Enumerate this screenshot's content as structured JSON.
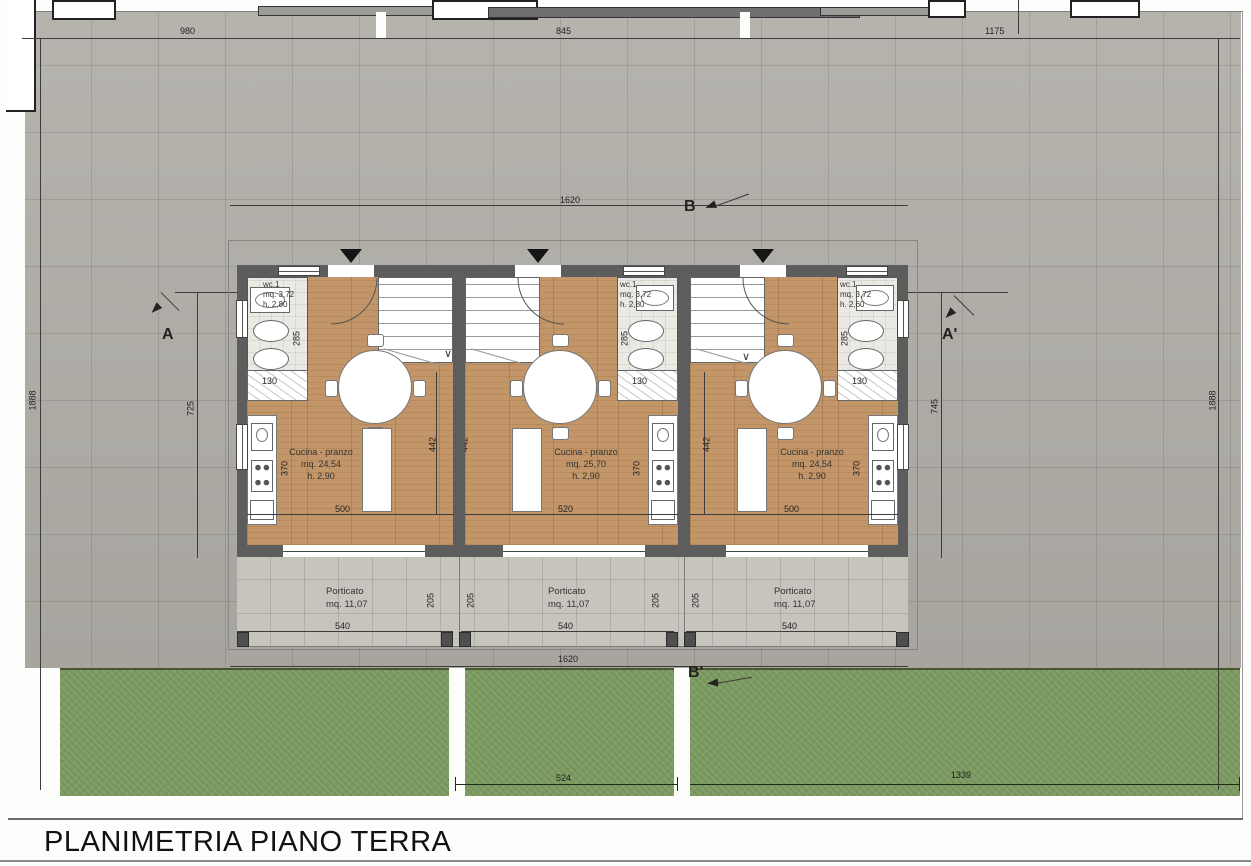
{
  "title": "PLANIMETRIA PIANO TERRA",
  "site": {
    "dim_top_left": "980",
    "dim_top_mid": "845",
    "dim_top_right": "1175",
    "dim_left": "1888",
    "dim_right": "1888",
    "dim_bottom_mid": "524",
    "dim_bottom_right": "1339",
    "dim_building_top": "1620",
    "dim_building_bottom": "1620",
    "dim_depth_left": "725",
    "dim_depth_right": "745"
  },
  "sections": {
    "a": "A",
    "a_prime": "A'",
    "b": "B",
    "b_prime": "B'"
  },
  "icons": {
    "stair_arrow": "∨"
  },
  "units": [
    {
      "kitchen_label": "Cucina - pranzo",
      "kitchen_area": "mq. 24,54",
      "kitchen_height": "h. 2,90",
      "wc_label": "wc.1",
      "wc_area": "mq. 3,72",
      "wc_height": "h. 2,80",
      "portico_label": "Porticato",
      "portico_area": "mq. 11,07",
      "dim_width": "500",
      "dim_depth": "370",
      "dim_wc_depth": "285",
      "dim_wc_width": "130",
      "dim_portico_width": "540",
      "dim_portico_depth": "205",
      "dim_mid": "442"
    },
    {
      "kitchen_label": "Cucina - pranzo",
      "kitchen_area": "mq. 25,70",
      "kitchen_height": "h. 2,90",
      "wc_label": "wc.1",
      "wc_area": "mq. 3,72",
      "wc_height": "h. 2,80",
      "portico_label": "Porticato",
      "portico_area": "mq. 11,07",
      "dim_width": "520",
      "dim_depth": "370",
      "dim_wc_depth": "285",
      "dim_wc_width": "130",
      "dim_portico_width": "540",
      "dim_portico_depth": "205",
      "dim_mid": "442"
    },
    {
      "kitchen_label": "Cucina - pranzo",
      "kitchen_area": "mq. 24,54",
      "kitchen_height": "h. 2,90",
      "wc_label": "wc.1",
      "wc_area": "mq. 3,72",
      "wc_height": "h. 2,60",
      "portico_label": "Porticato",
      "portico_area": "mq. 11,07",
      "dim_width": "500",
      "dim_depth": "370",
      "dim_wc_depth": "285",
      "dim_wc_width": "130",
      "dim_portico_width": "540",
      "dim_portico_depth": "205",
      "dim_mid": "442"
    }
  ]
}
